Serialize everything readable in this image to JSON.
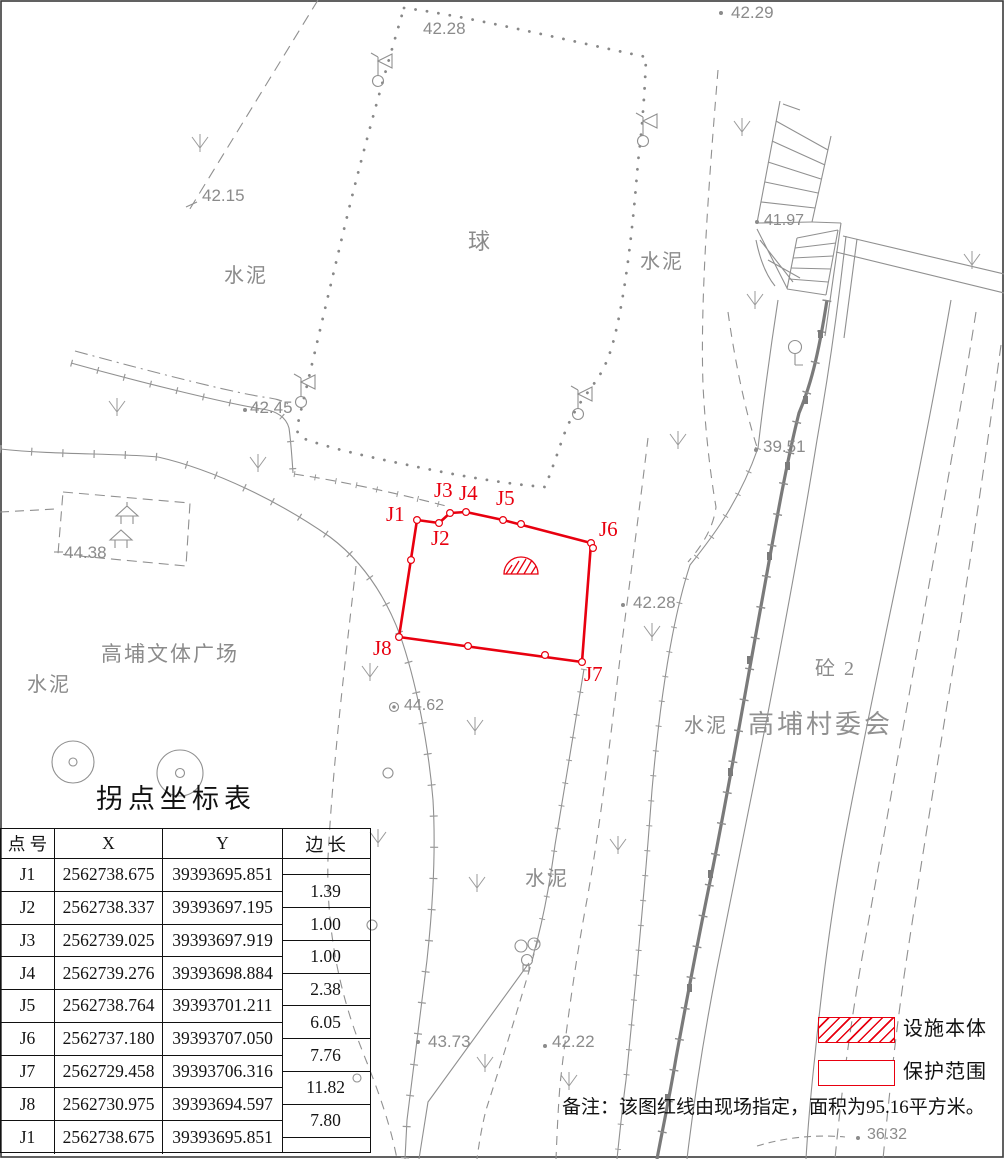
{
  "map": {
    "court_label": "球",
    "labels": {
      "cement": "水泥",
      "plaza": "高埔文体广场",
      "committee": "高埔村委会",
      "building": "砼 2"
    },
    "elevations": [
      "42.29",
      "42.28",
      "42.15",
      "41.97",
      "42.45",
      "39.51",
      "44.38",
      "42.28",
      "44.62",
      "43.73",
      "42.22",
      "36.32"
    ],
    "points": [
      "J1",
      "J2",
      "J3",
      "J4",
      "J5",
      "J6",
      "J7",
      "J8"
    ]
  },
  "table": {
    "title": "拐点坐标表",
    "headers": {
      "point": "点 号",
      "x": "X",
      "y": "Y",
      "edge": "边 长"
    },
    "rows": [
      {
        "id": "J1",
        "x": "2562738.675",
        "y": "39393695.851"
      },
      {
        "id": "J2",
        "x": "2562738.337",
        "y": "39393697.195"
      },
      {
        "id": "J3",
        "x": "2562739.025",
        "y": "39393697.919"
      },
      {
        "id": "J4",
        "x": "2562739.276",
        "y": "39393698.884"
      },
      {
        "id": "J5",
        "x": "2562738.764",
        "y": "39393701.211"
      },
      {
        "id": "J6",
        "x": "2562737.180",
        "y": "39393707.050"
      },
      {
        "id": "J7",
        "x": "2562729.458",
        "y": "39393706.316"
      },
      {
        "id": "J8",
        "x": "2562730.975",
        "y": "39393694.597"
      },
      {
        "id": "J1",
        "x": "2562738.675",
        "y": "39393695.851"
      }
    ],
    "edge_lengths": [
      "1.39",
      "1.00",
      "1.00",
      "2.38",
      "6.05",
      "7.76",
      "11.82",
      "7.80"
    ]
  },
  "legend": {
    "facility": "设施本体",
    "protection": "保护范围"
  },
  "note": "备注：该图红线由现场指定，面积为95.16平方米。",
  "colors": {
    "red": "#e8000f",
    "map_gray": "#8f8f8f",
    "black": "#141414"
  }
}
